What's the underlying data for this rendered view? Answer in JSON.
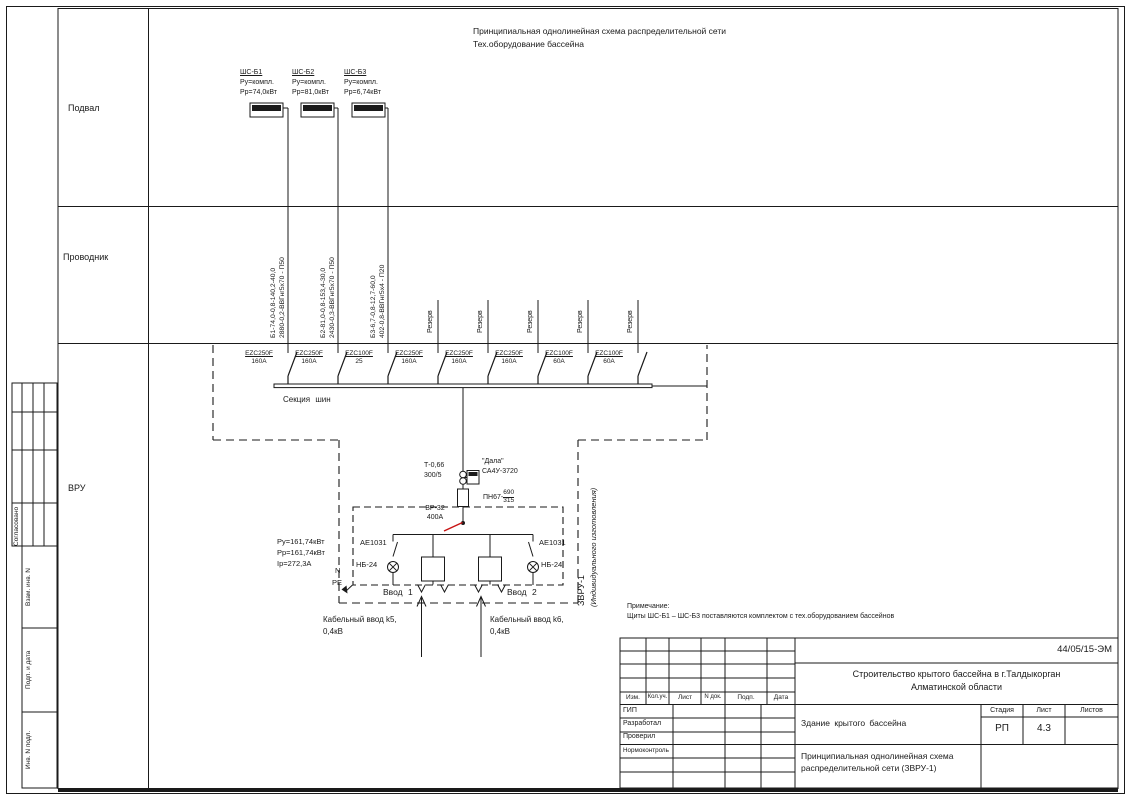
{
  "meta": {
    "title_line1": "Принципиальная однолинейная схема распределительной сети",
    "title_line2": "Тех.оборудование бассейна"
  },
  "regions": {
    "basement": "Подвал",
    "conductor": "Проводник",
    "vru": "ВРУ"
  },
  "panels": [
    {
      "name": "ШС-Б1",
      "pu": "Ру=компл.",
      "pp": "Рр=74,0кВт"
    },
    {
      "name": "ШС-Б2",
      "pu": "Ру=компл.",
      "pp": "Рр=81,0кВт"
    },
    {
      "name": "ШС-Б3",
      "pu": "Ру=компл.",
      "pp": "Рр=6,74кВт"
    }
  ],
  "cables": [
    {
      "line1": "Б1-74,0-0,8-140,2-40,0",
      "line2": "2880-0,2-ВВГнг5х70 - П50"
    },
    {
      "line1": "Б2-81,0-0,8-153,4-30,0",
      "line2": "2430-0,3-ВВГнг5х70 - П50"
    },
    {
      "line1": "Б3-6,7-0,8-12,7-60,0",
      "line2": "402-0,8-ВВГнг5х4 - П20"
    }
  ],
  "reserve_label": "Резерв",
  "breakers": [
    {
      "model": "EZC250F",
      "rating": "160A"
    },
    {
      "model": "EZC250F",
      "rating": "160A"
    },
    {
      "model": "EZC100F",
      "rating": "25"
    },
    {
      "model": "EZC250F",
      "rating": "160A"
    },
    {
      "model": "EZC250F",
      "rating": "160A"
    },
    {
      "model": "EZC250F",
      "rating": "160A"
    },
    {
      "model": "EZC100F",
      "rating": "60A"
    },
    {
      "model": "EZC100F",
      "rating": "60A"
    }
  ],
  "bus": {
    "section_label": "Секция шин"
  },
  "incomer": {
    "ct": {
      "line1": "Т-0,66",
      "line2": "300/5"
    },
    "meter": {
      "line1": "\"Дала\"",
      "line2": "СА4У-3720"
    },
    "fuse": {
      "prefix": "ПН67-",
      "num": "690",
      "den": "315"
    },
    "switch": {
      "line1": "ВР-32",
      "line2": "400А"
    },
    "power": {
      "line1": "Ру=161,74кВт",
      "line2": "Рр=161,74кВт",
      "line3": "Iр=272,3А"
    },
    "ae_left": "АЕ1031",
    "ae_right": "АЕ1031",
    "lamp_left": "НБ-24",
    "lamp_right": "НБ-24",
    "n_label": "N",
    "pe_label": "PE",
    "vvod1": "Ввод 1",
    "vvod2": "Ввод 2",
    "cable_in1_line1": "Кабельный ввод k5,",
    "cable_in1_line2": "0,4кВ",
    "cable_in2_line1": "Кабельный ввод k6,",
    "cable_in2_line2": "0,4кВ",
    "enclosure": "ЗВРУ-1",
    "enclosure_sub": "(Индивидуального изготовления)"
  },
  "note": {
    "line1": "Примечание:",
    "line2": "Щиты ШС-Б1 – ШС-Б3 поставляются комплектом с тех.оборудованием бассейнов"
  },
  "stamp": {
    "doc_no": "44/05/15-ЭМ",
    "project_line1": "Строительство крытого бассейна в г.Талдыкорган",
    "project_line2": "Алматинской области",
    "object_name": "Здание крытого бассейна",
    "doc_title_line1": "Принципиальная однолинейная схема",
    "doc_title_line2": "распределительной сети (ЗВРУ-1)",
    "stage_label": "Стадия",
    "sheet_label": "Лист",
    "sheets_label": "Листов",
    "stage": "РП",
    "sheet": "4.3",
    "cols": [
      "Изм.",
      "Кол.уч.",
      "Лист",
      "N док.",
      "Подп.",
      "Дата"
    ],
    "roles": [
      "ГИП",
      "Разработал",
      "Проверил",
      "Нормоконтроль"
    ]
  },
  "side": {
    "approved": "Согласовано",
    "vzam": "Взам. инв. N",
    "podp": "Подп. и дата",
    "inv": "Инв. N подл."
  }
}
